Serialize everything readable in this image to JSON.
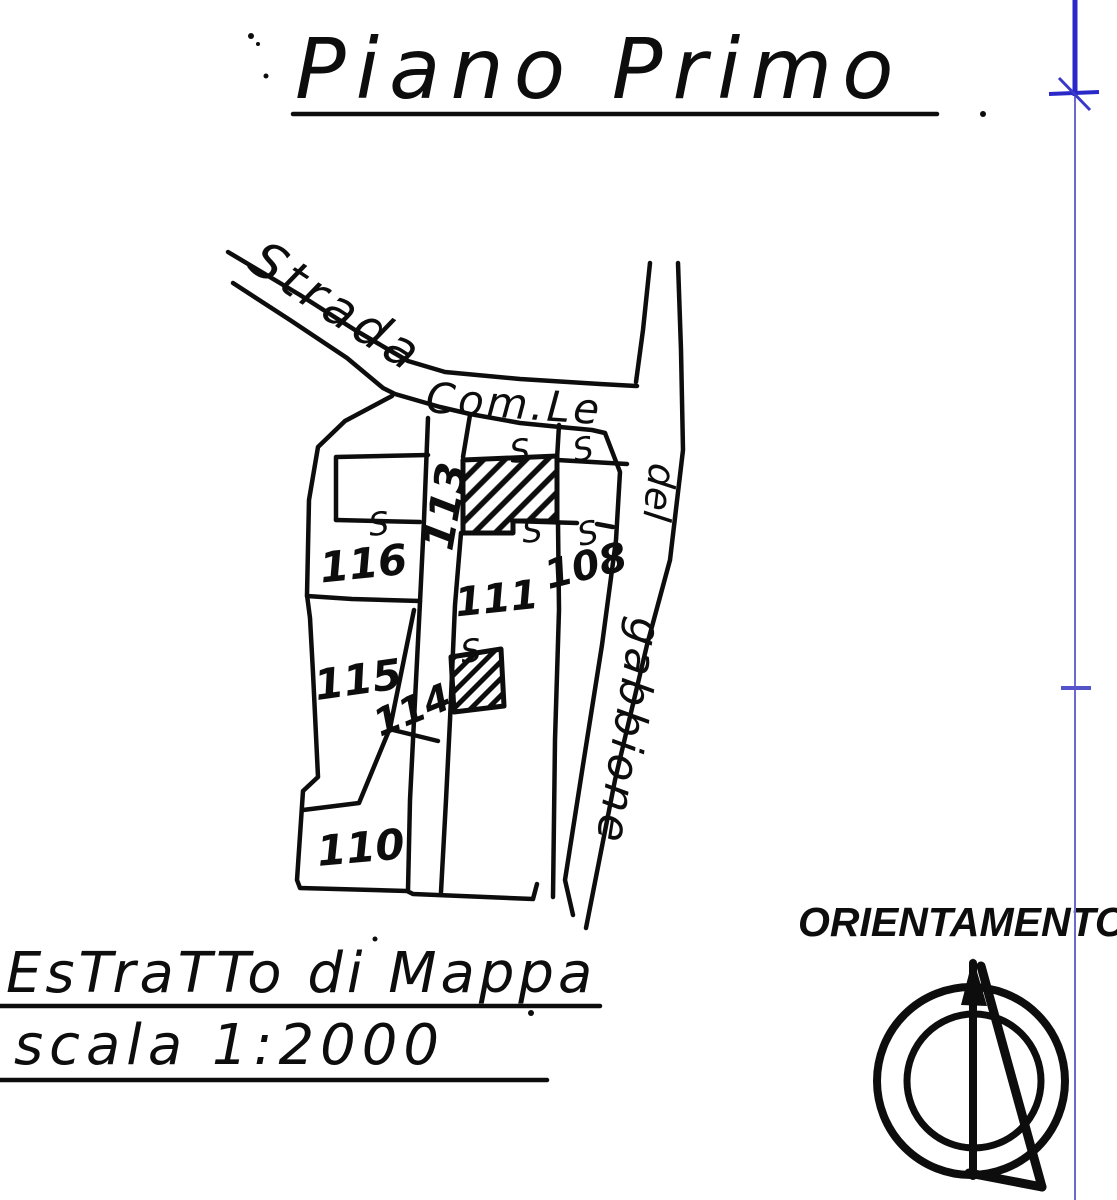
{
  "title": {
    "text": "Piano Primo"
  },
  "map": {
    "road_labels": {
      "strada": "Strada",
      "comle": "Com.Le",
      "del": "del",
      "gabbione": "gabbione"
    },
    "parcels": [
      {
        "number": "116"
      },
      {
        "number": "113"
      },
      {
        "number": "108"
      },
      {
        "number": "111"
      },
      {
        "number": "115"
      },
      {
        "number": "114"
      },
      {
        "number": "110"
      }
    ],
    "stair_mark": "S"
  },
  "footer": {
    "line1": "EsTraTTo di Mappa",
    "line2": "scala 1:2000"
  },
  "orientation": {
    "label": "ORIENTAMENTO"
  },
  "colors": {
    "ink": "#0d0d0d",
    "register_blue": "#2a28c8",
    "register_blue_light": "#6b6ad2"
  }
}
